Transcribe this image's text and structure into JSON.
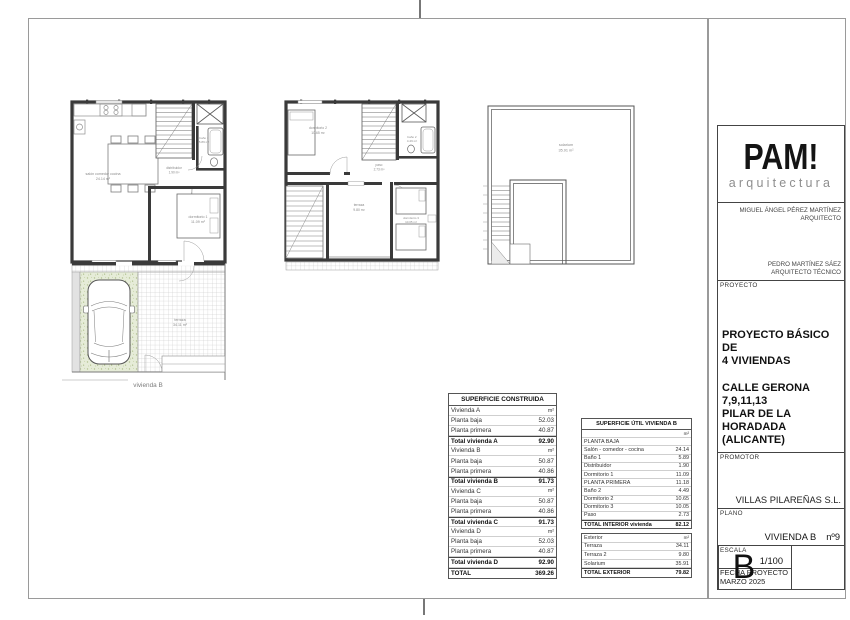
{
  "plans": {
    "ground": {
      "salon_label": "salón comedor cocina",
      "salon_area": "24.14 m²",
      "dorm1_label": "dormitorio 1",
      "dorm1_area": "11.09 m²",
      "distribuidor_label": "distribuidor",
      "distribuidor_area": "1.90 m²",
      "bano1_label": "baño 1",
      "bano1_area": "5.89 m²"
    },
    "first": {
      "dorm2_label": "dormitorio 2",
      "dorm2_area": "10.65 m²",
      "bano2_label": "baño 2",
      "bano2_area": "4.49 m²",
      "paso_label": "paso",
      "paso_area": "2.73 m²",
      "terraza2_label": "terraza",
      "terraza2_area": "9.80 m²",
      "dorm3_label": "dormitorio 3",
      "dorm3_area": "10.05 m²"
    },
    "roof": {
      "solarium_label": "solarium",
      "solarium_area": "35.91 m²"
    },
    "garden": {
      "terraza_label": "terraza",
      "terraza_area": "34.11 m²",
      "caption": "vivienda B"
    }
  },
  "tables": {
    "construida": {
      "title": "SUPERFICIE CONSTRUIDA",
      "rows": [
        {
          "label": "Vivienda A",
          "value": "m²",
          "style": "sub"
        },
        {
          "label": "Planta baja",
          "value": "52.03",
          "style": "item"
        },
        {
          "label": "Planta primera",
          "value": "40.87",
          "style": "item"
        },
        {
          "label": "Total vivienda A",
          "value": "92.90",
          "style": "total"
        },
        {
          "label": "Vivienda B",
          "value": "m²",
          "style": "sub"
        },
        {
          "label": "Planta baja",
          "value": "50.87",
          "style": "item"
        },
        {
          "label": "Planta primera",
          "value": "40.86",
          "style": "item"
        },
        {
          "label": "Total vivienda B",
          "value": "91.73",
          "style": "total"
        },
        {
          "label": "Vivienda C",
          "value": "m²",
          "style": "sub"
        },
        {
          "label": "Planta baja",
          "value": "50.87",
          "style": "item"
        },
        {
          "label": "Planta primera",
          "value": "40.86",
          "style": "item"
        },
        {
          "label": "Total vivienda C",
          "value": "91.73",
          "style": "total"
        },
        {
          "label": "Vivienda D",
          "value": "m²",
          "style": "sub"
        },
        {
          "label": "Planta baja",
          "value": "52.03",
          "style": "item"
        },
        {
          "label": "Planta primera",
          "value": "40.87",
          "style": "item"
        },
        {
          "label": "Total vivienda D",
          "value": "92.90",
          "style": "total"
        },
        {
          "label": "TOTAL",
          "value": "369.26",
          "style": "grand"
        }
      ]
    },
    "util": {
      "title": "SUPERFICIE ÚTIL VIVIENDA B",
      "interior_rows": [
        {
          "label": "",
          "value": "m²",
          "style": "sub"
        },
        {
          "label": "PLANTA BAJA",
          "value": "",
          "style": "section"
        },
        {
          "label": "Salón - comedor - cocina",
          "value": "24.14",
          "style": "item"
        },
        {
          "label": "Baño 1",
          "value": "5.89",
          "style": "item"
        },
        {
          "label": "Distribuidor",
          "value": "1.90",
          "style": "item"
        },
        {
          "label": "Dormitorio 1",
          "value": "11.09",
          "style": "item"
        },
        {
          "label": "PLANTA PRIMERA",
          "value": "11.18",
          "style": "section"
        },
        {
          "label": "Baño 2",
          "value": "4.49",
          "style": "item"
        },
        {
          "label": "Dormitorio 2",
          "value": "10.65",
          "style": "item"
        },
        {
          "label": "Dormitorio 3",
          "value": "10.05",
          "style": "item"
        },
        {
          "label": "Paso",
          "value": "2.73",
          "style": "item"
        },
        {
          "label": "TOTAL INTERIOR vivienda",
          "value": "82.12",
          "style": "grand"
        }
      ],
      "exterior_rows": [
        {
          "label": "Exterior",
          "value": "m²",
          "style": "sub"
        },
        {
          "label": "Terraza",
          "value": "34.11",
          "style": "item"
        },
        {
          "label": "Terraza 2",
          "value": "9.80",
          "style": "item"
        },
        {
          "label": "Solarium",
          "value": "35.91",
          "style": "item"
        },
        {
          "label": "TOTAL EXTERIOR",
          "value": "79.82",
          "style": "grand"
        }
      ]
    }
  },
  "titleblock": {
    "logo_text": "PAM!",
    "logo_subtext": "arquitectura",
    "architect": {
      "name": "MIGUEL ÁNGEL PÉREZ MARTÍNEZ",
      "role": "ARQUITECTO"
    },
    "technical_architect": {
      "name": "PEDRO MARTÍNEZ SÁEZ",
      "role": "ARQUITECTO TÉCNICO"
    },
    "proyecto": {
      "label": "PROYECTO",
      "title_line1": "PROYECTO BÁSICO DE",
      "title_line2": "4 VIVIENDAS",
      "addr_line1": "CALLE GERONA",
      "addr_line2": "7,9,11,13",
      "addr_line3": "PILAR DE LA HORADADA",
      "addr_line4": "(ALICANTE)"
    },
    "promotor": {
      "label": "PROMOTOR",
      "value": "VILLAS PILAREÑAS S.L."
    },
    "plano": {
      "label": "PLANO",
      "value": "VIVIENDA B",
      "number": "nº9"
    },
    "escala": {
      "label": "ESCALA",
      "value": "1/100"
    },
    "fecha": {
      "label": "FECHA PROYECTO",
      "value": "MARZO 2025"
    },
    "sheet_letter": "B"
  },
  "colors": {
    "wall": "#3a3a3a",
    "frame": "#9a9a9a",
    "grass": "#e6ecd8",
    "label": "#8a8a8a"
  }
}
